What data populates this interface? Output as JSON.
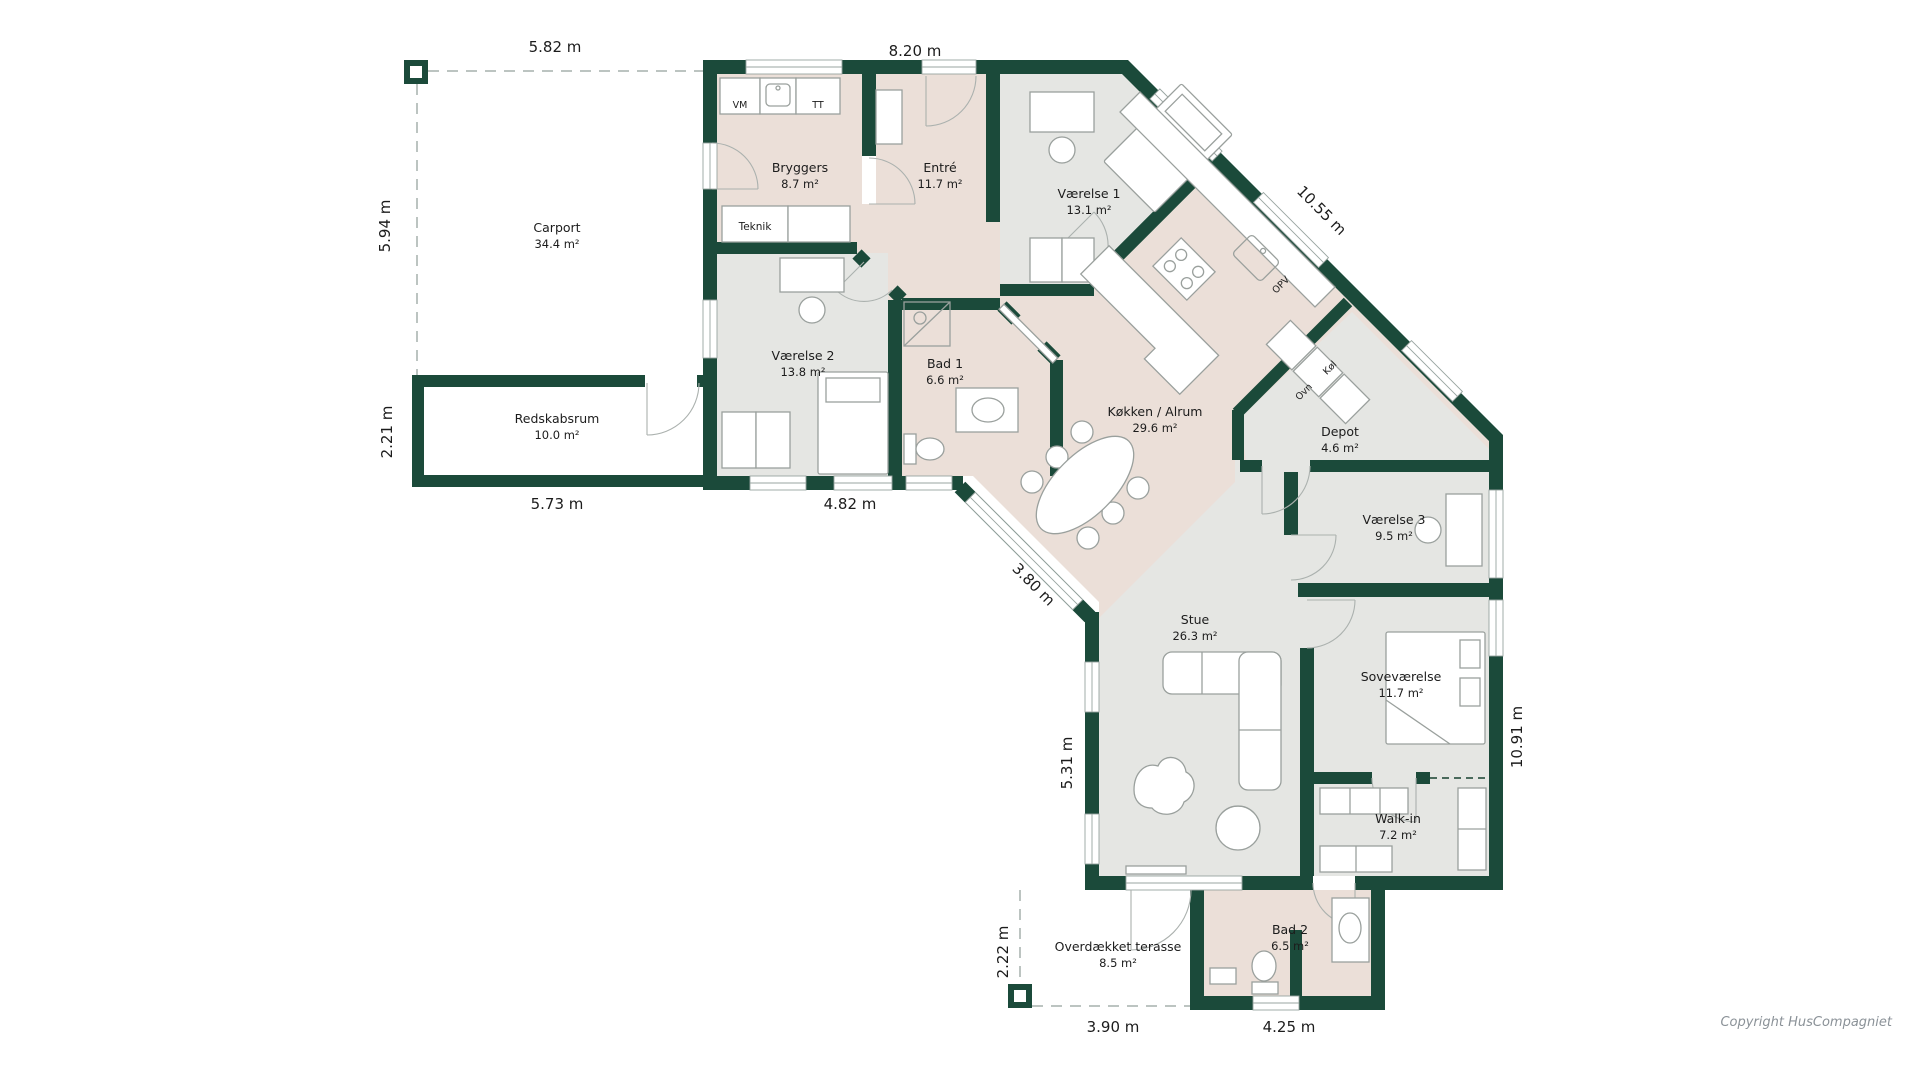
{
  "colors": {
    "wall": "#1b4a3a",
    "floor_warm": "#ebdfd8",
    "floor_cool": "#e5e6e3",
    "floor_white": "#ffffff",
    "dash": "#bcc4c1",
    "furniture_stroke": "#9aa09d",
    "text": "#1c1c1c",
    "copyright_text": "#8b9298"
  },
  "rooms": [
    {
      "id": "carport",
      "name": "Carport",
      "area": "34.4 m²"
    },
    {
      "id": "redskabsrum",
      "name": "Redskabsrum",
      "area": "10.0 m²"
    },
    {
      "id": "bryggers",
      "name": "Bryggers",
      "area": "8.7 m²"
    },
    {
      "id": "entre",
      "name": "Entré",
      "area": "11.7 m²"
    },
    {
      "id": "vaerelse1",
      "name": "Værelse 1",
      "area": "13.1 m²"
    },
    {
      "id": "vaerelse2",
      "name": "Værelse 2",
      "area": "13.8 m²"
    },
    {
      "id": "bad1",
      "name": "Bad 1",
      "area": "6.6 m²"
    },
    {
      "id": "kokken",
      "name": "Køkken / Alrum",
      "area": "29.6 m²"
    },
    {
      "id": "depot",
      "name": "Depot",
      "area": "4.6 m²"
    },
    {
      "id": "vaerelse3",
      "name": "Værelse 3",
      "area": "9.5 m²"
    },
    {
      "id": "stue",
      "name": "Stue",
      "area": "26.3 m²"
    },
    {
      "id": "sovevaerelse",
      "name": "Soveværelse",
      "area": "11.7 m²"
    },
    {
      "id": "walkin",
      "name": "Walk-in",
      "area": "7.2 m²"
    },
    {
      "id": "bad2",
      "name": "Bad 2",
      "area": "6.5 m²"
    },
    {
      "id": "terrasse",
      "name": "Overdækket terasse",
      "area": "8.5 m²"
    }
  ],
  "fixtures": {
    "teknik": "Teknik",
    "vm": "VM",
    "tt": "TT",
    "opv": "OPV",
    "ovn": "Ovn",
    "kol": "Køl"
  },
  "dimensions": {
    "carport_top": "5.82 m",
    "wing_top": "8.20 m",
    "carport_left": "5.94 m",
    "redskab_left": "2.21 m",
    "redskab_bottom": "5.73 m",
    "wing_bottom": "4.82 m",
    "ne_diagonal": "10.55 m",
    "sw_diagonal": "3.80 m",
    "stue_left": "5.31 m",
    "terrasse_left": "2.22 m",
    "wing_right": "10.91 m",
    "terrasse_bottom": "3.90 m",
    "bad2_bottom": "4.25 m"
  },
  "copyright": "Copyright HusCompagniet"
}
